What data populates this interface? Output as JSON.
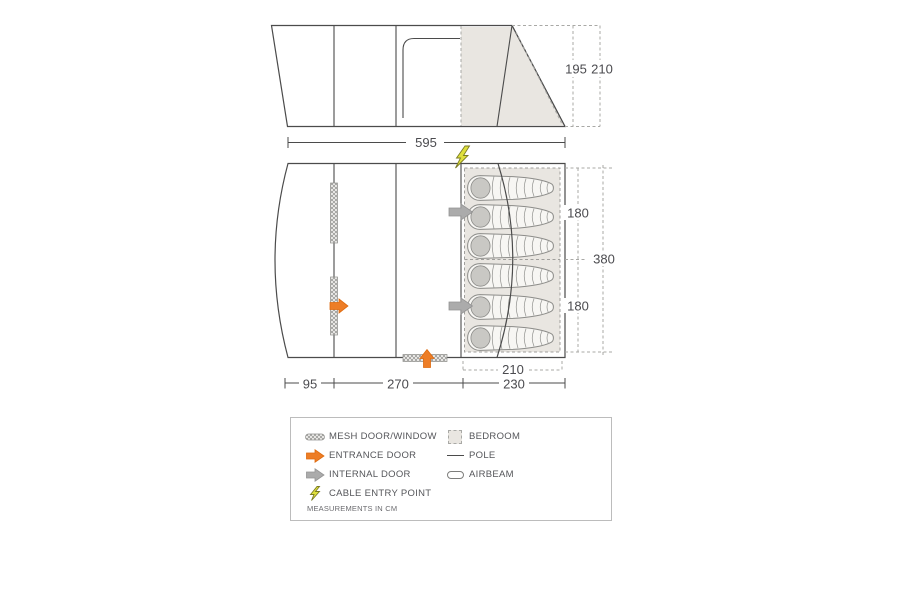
{
  "diagram": {
    "type": "tent-floorplan",
    "beds_count": 6,
    "dims": {
      "side_width": "595",
      "height_inner": "195",
      "height_peak": "210",
      "bedroom_top": "180",
      "bedroom_bottom": "180",
      "total_depth": "380",
      "bedroom_inner": "210",
      "front": "95",
      "living": "270",
      "bedroom_depth": "230"
    }
  },
  "legend": {
    "left": [
      {
        "icon": "mesh-door-window-icon",
        "label": "MESH DOOR/WINDOW"
      },
      {
        "icon": "entrance-door-icon",
        "label": "ENTRANCE DOOR"
      },
      {
        "icon": "internal-door-icon",
        "label": "INTERNAL DOOR"
      },
      {
        "icon": "cable-entry-point-icon",
        "label": "CABLE ENTRY POINT"
      }
    ],
    "right": [
      {
        "icon": "bedroom-icon",
        "label": "BEDROOM"
      },
      {
        "icon": "pole-icon",
        "label": "POLE"
      },
      {
        "icon": "airbeam-icon",
        "label": "AIRBEAM"
      }
    ],
    "note": "MEASUREMENTS IN CM"
  },
  "colors": {
    "outline": "#4b4b4b",
    "dashed": "#a9a9a6",
    "shade": "#e9e6e1",
    "entrance_orange": "#ed7d26",
    "internal_grey": "#ababab",
    "cable_yellow": "#dfe03c",
    "text": "#4b4b4f"
  }
}
